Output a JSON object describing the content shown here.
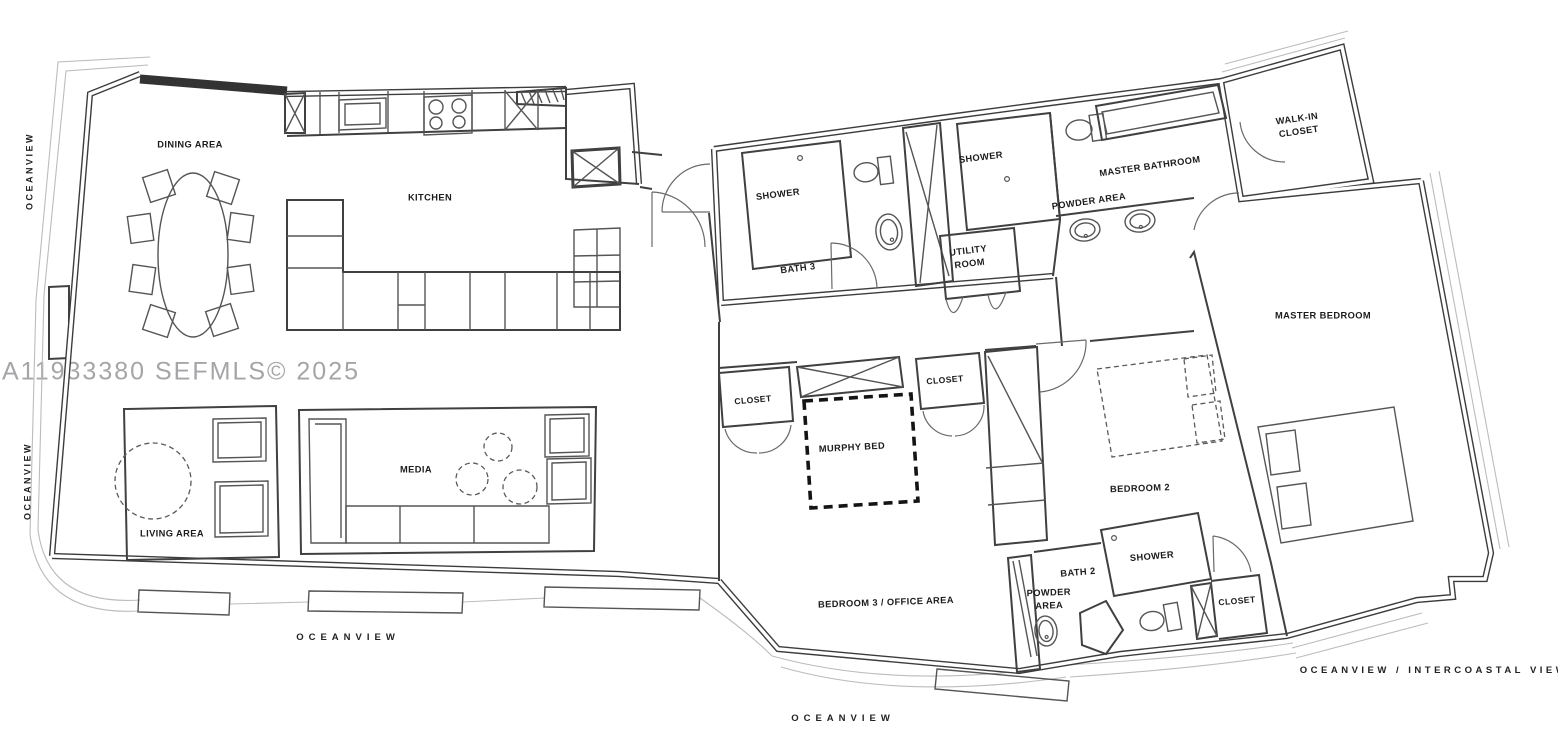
{
  "watermark": "A11933380 SEFMLS© 2025",
  "view_labels": {
    "left_top": "OCEANVIEW",
    "left_bottom": "OCEANVIEW",
    "bottom_left": "OCEANVIEW",
    "bottom_center": "OCEANVIEW",
    "bottom_right": "OCEANVIEW / INTERCOASTAL VIEW"
  },
  "rooms": {
    "dining_area": "DINING AREA",
    "kitchen": "KITCHEN",
    "living_area": "LIVING AREA",
    "media": "MEDIA",
    "bath3_shower": "SHOWER",
    "bath3": "BATH 3",
    "utility_room": {
      "line1": "UTILITY",
      "line2": "ROOM"
    },
    "master_shower": "SHOWER",
    "master_bathroom": "MASTER BATHROOM",
    "master_powder_area": "POWDER AREA",
    "walk_in_closet": {
      "line1": "WALK-IN",
      "line2": "CLOSET"
    },
    "master_bedroom": "MASTER BEDROOM",
    "hall_closet_left": "CLOSET",
    "hall_closet_right": "CLOSET",
    "murphy_bed": "MURPHY BED",
    "bedroom_2": "BEDROOM 2",
    "bedroom_3": "BEDROOM 3 / OFFICE AREA",
    "bath_2": "BATH 2",
    "bath2_shower": "SHOWER",
    "bath2_closet": "CLOSET",
    "bath2_powder_area": {
      "line1": "POWDER",
      "line2": "AREA"
    }
  },
  "colors": {
    "background": "#ffffff",
    "wall": "#3c3c3c",
    "line": "#555555",
    "thin_balcony": "#bcbcbc",
    "label": "#1c1c1c",
    "watermark": "#96969a",
    "murphy_bed_outline": "#141414"
  }
}
